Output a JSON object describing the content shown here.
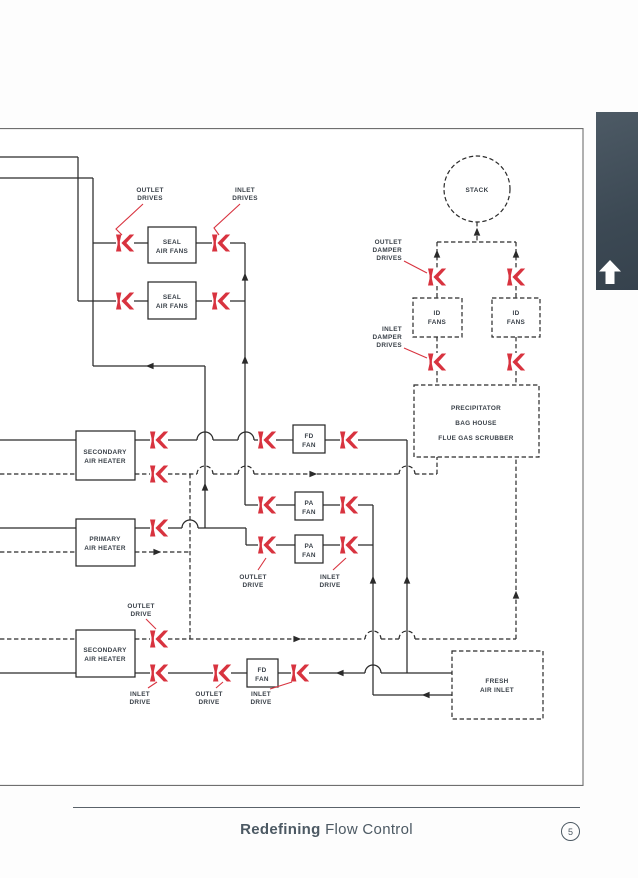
{
  "footer": {
    "brand_bold": "Redefining",
    "brand_regular": "Flow Control",
    "page_number": "5"
  },
  "side_tab": {
    "icon": "up-arrow"
  },
  "diagram": {
    "colors": {
      "actuator_red": "#d8333f",
      "line": "#2a2a2a",
      "label": "#3a4149",
      "tab_slate": "#3f4c57",
      "footer_gray_blue": "#4c5963"
    },
    "boxes": {
      "stack": "STACK",
      "seal_air_fans": [
        "SEAL",
        "AIR FANS"
      ],
      "id_fans": [
        "ID",
        "FANS"
      ],
      "precipitator": [
        "PRECIPITATOR",
        "BAG HOUSE",
        "FLUE GAS SCRUBBER"
      ],
      "secondary_air_heater": [
        "SECONDARY",
        "AIR HEATER"
      ],
      "primary_air_heater": [
        "PRIMARY",
        "AIR HEATER"
      ],
      "fd_fan": [
        "FD",
        "FAN"
      ],
      "pa_fan": [
        "PA",
        "FAN"
      ],
      "fresh_air_inlet": [
        "FRESH",
        "AIR INLET"
      ]
    },
    "drive_labels": {
      "outlet_drives": [
        "OUTLET",
        "DRIVES"
      ],
      "inlet_drives": [
        "INLET",
        "DRIVES"
      ],
      "outlet_damper_drives": [
        "OUTLET",
        "DAMPER",
        "DRIVES"
      ],
      "inlet_damper_drives": [
        "INLET",
        "DAMPER",
        "DRIVES"
      ],
      "outlet_drive": [
        "OUTLET",
        "DRIVE"
      ],
      "inlet_drive": [
        "INLET",
        "DRIVE"
      ]
    }
  }
}
